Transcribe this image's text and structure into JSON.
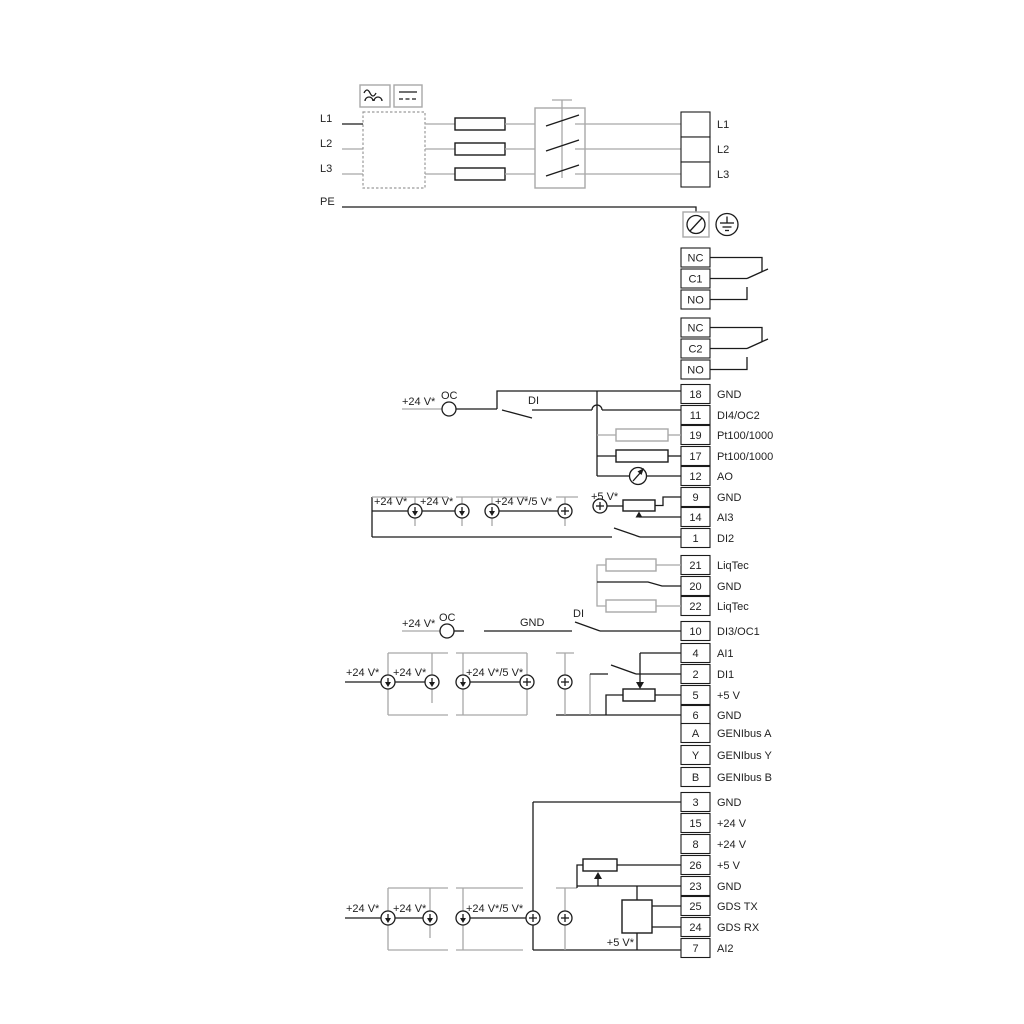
{
  "power": {
    "in": [
      "L1",
      "L2",
      "L3",
      "PE"
    ],
    "out": [
      "L1",
      "L2",
      "L3"
    ]
  },
  "relay1": {
    "t": [
      "NC",
      "C1",
      "NO"
    ]
  },
  "relay2": {
    "t": [
      "NC",
      "C2",
      "NO"
    ]
  },
  "io1": [
    {
      "num": "18",
      "label": "GND"
    },
    {
      "num": "11",
      "label": "DI4/OC2"
    },
    {
      "num": "19",
      "label": "Pt100/1000"
    },
    {
      "num": "17",
      "label": "Pt100/1000"
    },
    {
      "num": "12",
      "label": "AO"
    },
    {
      "num": "9",
      "label": "GND"
    },
    {
      "num": "14",
      "label": "AI3"
    },
    {
      "num": "1",
      "label": "DI2"
    }
  ],
  "liq": [
    {
      "num": "21",
      "label": "LiqTec"
    },
    {
      "num": "20",
      "label": "GND"
    },
    {
      "num": "22",
      "label": "LiqTec"
    }
  ],
  "io2": [
    {
      "num": "10",
      "label": "DI3/OC1"
    }
  ],
  "io3": [
    {
      "num": "4",
      "label": "AI1"
    },
    {
      "num": "2",
      "label": "DI1"
    },
    {
      "num": "5",
      "label": "+5 V"
    },
    {
      "num": "6",
      "label": "GND"
    }
  ],
  "geni": [
    {
      "num": "A",
      "label": "GENIbus A"
    },
    {
      "num": "Y",
      "label": "GENIbus Y"
    },
    {
      "num": "B",
      "label": "GENIbus B"
    }
  ],
  "io4": [
    {
      "num": "3",
      "label": "GND"
    },
    {
      "num": "15",
      "label": "+24 V"
    },
    {
      "num": "8",
      "label": "+24 V"
    },
    {
      "num": "26",
      "label": "+5 V"
    },
    {
      "num": "23",
      "label": "GND"
    },
    {
      "num": "25",
      "label": "GDS TX"
    },
    {
      "num": "24",
      "label": "GDS RX"
    },
    {
      "num": "7",
      "label": "AI2"
    }
  ],
  "ann": {
    "v24": "+24 V*",
    "v24_5": "+24 V*/5 V*",
    "v5": "+5 V*",
    "oc": "OC",
    "di": "DI",
    "gnd": "GND"
  }
}
